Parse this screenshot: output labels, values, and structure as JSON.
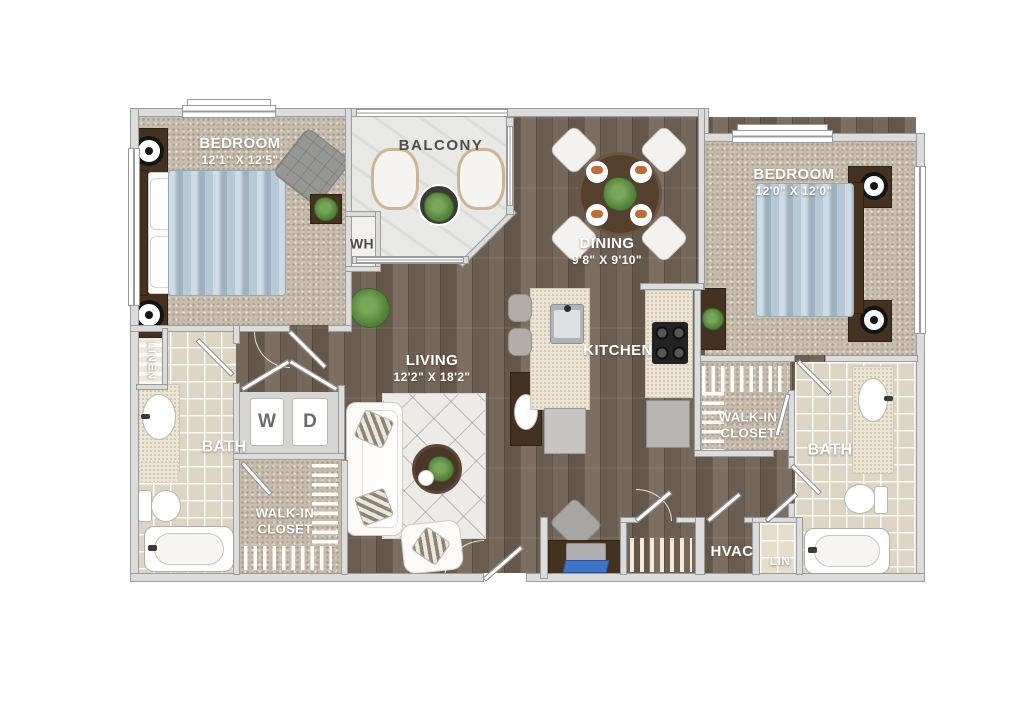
{
  "labels": {
    "bedroom_left": {
      "name": "BEDROOM",
      "dims": "12'1\" X 12'5\""
    },
    "bedroom_right": {
      "name": "BEDROOM",
      "dims": "12'0\" X 12'0\""
    },
    "balcony": {
      "name": "BALCONY"
    },
    "dining": {
      "name": "DINING",
      "dims": "9'8\" X 9'10\""
    },
    "living": {
      "name": "LIVING",
      "dims": "12'2\" X 18'2\""
    },
    "kitchen": {
      "name": "KITCHEN"
    },
    "bath_left": {
      "name": "BATH"
    },
    "bath_right": {
      "name": "BATH"
    },
    "walk_in_left": {
      "name": "WALK-IN CLOSET"
    },
    "walk_in_right": {
      "name": "WALK-IN CLOSET"
    },
    "linen": {
      "name": "LINEN"
    },
    "water_heater": {
      "name": "WH"
    },
    "washer": {
      "name": "W"
    },
    "dryer": {
      "name": "D"
    },
    "hvac": {
      "name": "HVAC"
    },
    "lin_closet": {
      "name": "LIN"
    }
  },
  "colors": {
    "wood_floor": "#71655a",
    "carpet": "#c7bcab",
    "bath_tile": "#ddd5c4",
    "balcony_marble": "#e8e8e6",
    "countertop": "#ece5d4",
    "wall": "#dcdcdc",
    "bedding_blue": "#b6c9d6",
    "plant_green": "#55863c",
    "laptop_screen_blue": "#3f74c9",
    "label_white": "#ffffff",
    "label_dark": "#4d4d4d"
  },
  "fixtures": [
    "bed",
    "nightstand",
    "table-lamp",
    "dresser",
    "accent-chair",
    "throw-blanket",
    "sofa",
    "area-rug",
    "coffee-table",
    "console-table",
    "decor-bowl",
    "dining-table",
    "dining-chair",
    "place-setting",
    "patio-chair",
    "patio-table",
    "kitchen-island",
    "kitchen-sink",
    "bar-stool",
    "cooktop",
    "refrigerator",
    "dishwasher",
    "washer",
    "dryer",
    "bathroom-vanity",
    "bathroom-sink",
    "toilet",
    "bathtub",
    "bath-mat",
    "desk",
    "laptop",
    "desk-chair",
    "potted-plant",
    "closet-shelving",
    "door",
    "window"
  ]
}
